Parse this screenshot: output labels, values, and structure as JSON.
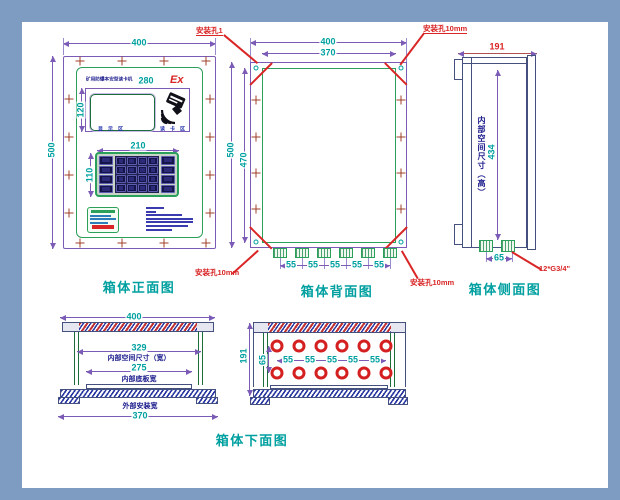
{
  "frame": {
    "color": "#7E9CC1"
  },
  "front_view": {
    "title": "箱体正面图",
    "dims": {
      "width": "400",
      "height": "500",
      "display_width": "280",
      "display_height": "120",
      "keypad_width": "210",
      "keypad_height": "110"
    },
    "display": {
      "header": "矿用防爆本安型读卡机",
      "ex_mark": "Ex",
      "caption_left": "显 示 区",
      "caption_right": "读 卡 区"
    }
  },
  "back_view": {
    "title": "箱体背面图",
    "dims": {
      "width": "400",
      "hole_spacing_width": "370",
      "height": "500",
      "hole_spacing_height": "470",
      "gland_spacing": "55"
    },
    "labels": {
      "mount_hole_1": "安装孔1",
      "mount_hole_10": "安装孔10mm"
    }
  },
  "side_view": {
    "title": "箱体侧面图",
    "dims": {
      "depth": "191",
      "inner_height": "434",
      "gland_spacing": "65"
    },
    "notes": {
      "inner_size": "内部空间尺寸（高）",
      "thread": "12*G3/4\""
    }
  },
  "bottom_view": {
    "title": "箱体下面图",
    "section": {
      "dims": {
        "outer_width": "400",
        "inner_width": "329",
        "plate_width": "275",
        "mount_width": "370"
      },
      "notes": {
        "inner": "内部空间尺寸（宽）",
        "plate": "内部底板宽",
        "mount": "外部安装宽"
      }
    },
    "holes": {
      "dims": {
        "depth": "191",
        "row_gap": "65",
        "spacing": "55"
      }
    }
  }
}
